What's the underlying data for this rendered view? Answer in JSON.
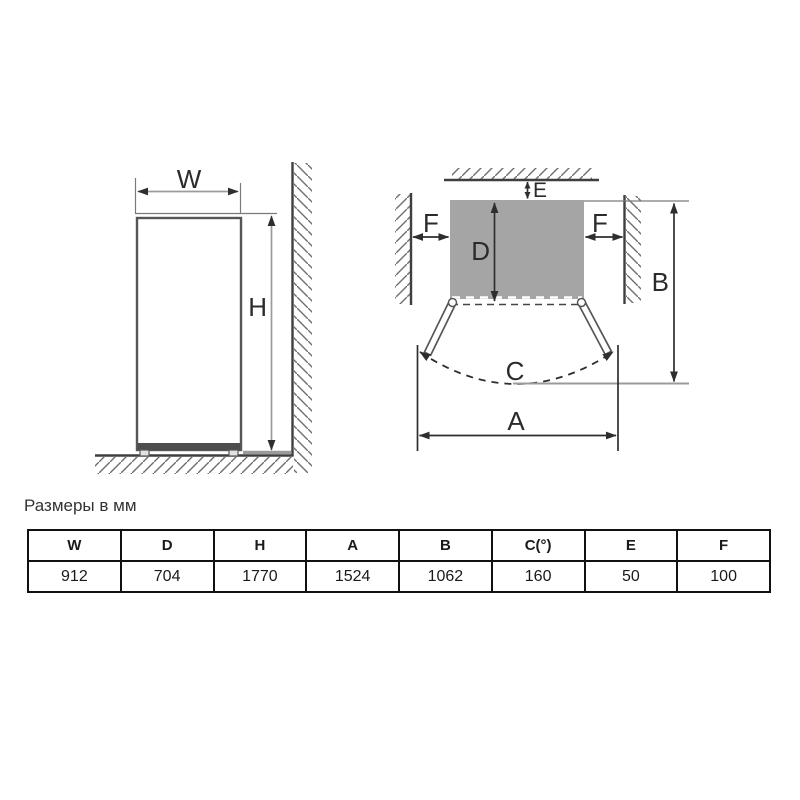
{
  "caption": {
    "text": "Размеры в мм"
  },
  "front_view": {
    "labels": {
      "width": "W",
      "height": "H"
    }
  },
  "top_view": {
    "labels": {
      "depth": "D",
      "rear_clearance": "E",
      "side_clearance_left": "F",
      "side_clearance_right": "F",
      "door_swing": "C",
      "total_depth": "B",
      "total_width": "A"
    }
  },
  "table": {
    "headers": [
      "W",
      "D",
      "H",
      "A",
      "B",
      "C(°)",
      "E",
      "F"
    ],
    "values": [
      "912",
      "704",
      "1770",
      "1524",
      "1062",
      "160",
      "50",
      "100"
    ]
  },
  "colors": {
    "line": "#2e2e2e",
    "wall": "#3f3f3f",
    "hatch": "#6f6f6f",
    "ref_gray": "#9b9b9b",
    "fridge_fill": "#a5a5a5",
    "fridge_outline": "#565656",
    "table_border": "#111111",
    "text_color": "#333333",
    "label_color": "#2b2b2b",
    "page_bg": "#ffffff"
  }
}
